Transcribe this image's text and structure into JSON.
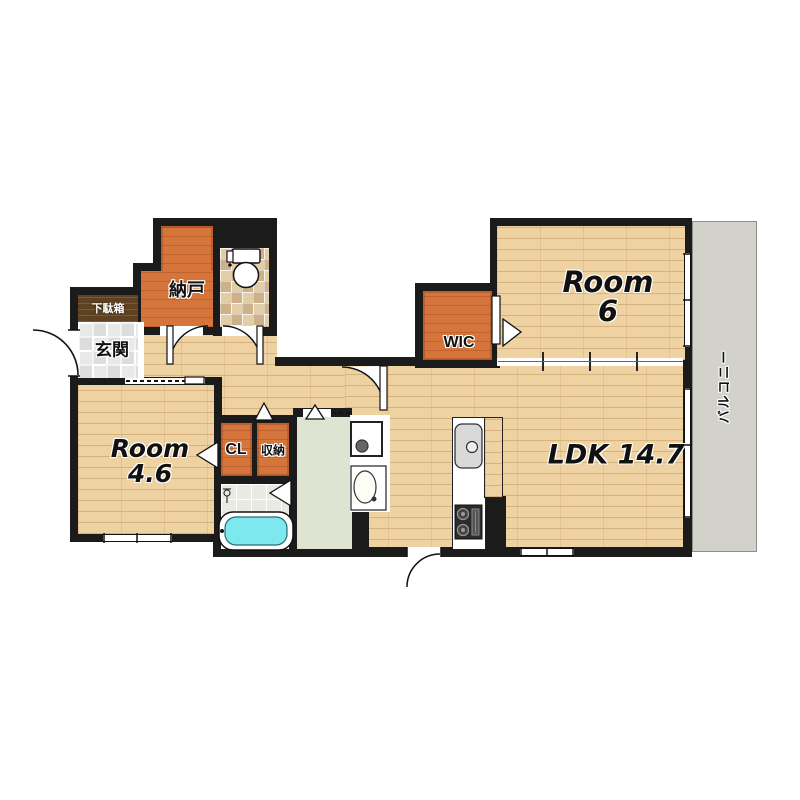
{
  "floorplan": {
    "title": "apartment-floorplan",
    "rooms": {
      "nando": {
        "label": "納戸"
      },
      "getabako": {
        "label": "下駄箱"
      },
      "genkan": {
        "label": "玄関"
      },
      "room6": {
        "name": "Room",
        "size": "6"
      },
      "wic": {
        "label": "WIC"
      },
      "ldk": {
        "label": "LDK 14.7"
      },
      "room46": {
        "name": "Room",
        "size": "4.6"
      },
      "cl": {
        "label": "CL"
      },
      "storage": {
        "label": "収納"
      },
      "balcony": {
        "label": "バルコニー"
      }
    },
    "fixtures": [
      "toilet-icon",
      "bathtub-icon",
      "shower-icon",
      "washbasin-icon",
      "washing-machine-pan-icon",
      "kitchen-sink-icon",
      "stove-icon"
    ],
    "colors": {
      "wall": "#1b1b1b",
      "wood_floor": "#eed2a2",
      "accent_orange": "#d5743b",
      "balcony_gray": "#d2d2cb",
      "washroom_sage": "#dde4d1",
      "bathtub_cyan": "#7de9ef",
      "shoe_cabinet_brown": "#5e4121"
    }
  }
}
